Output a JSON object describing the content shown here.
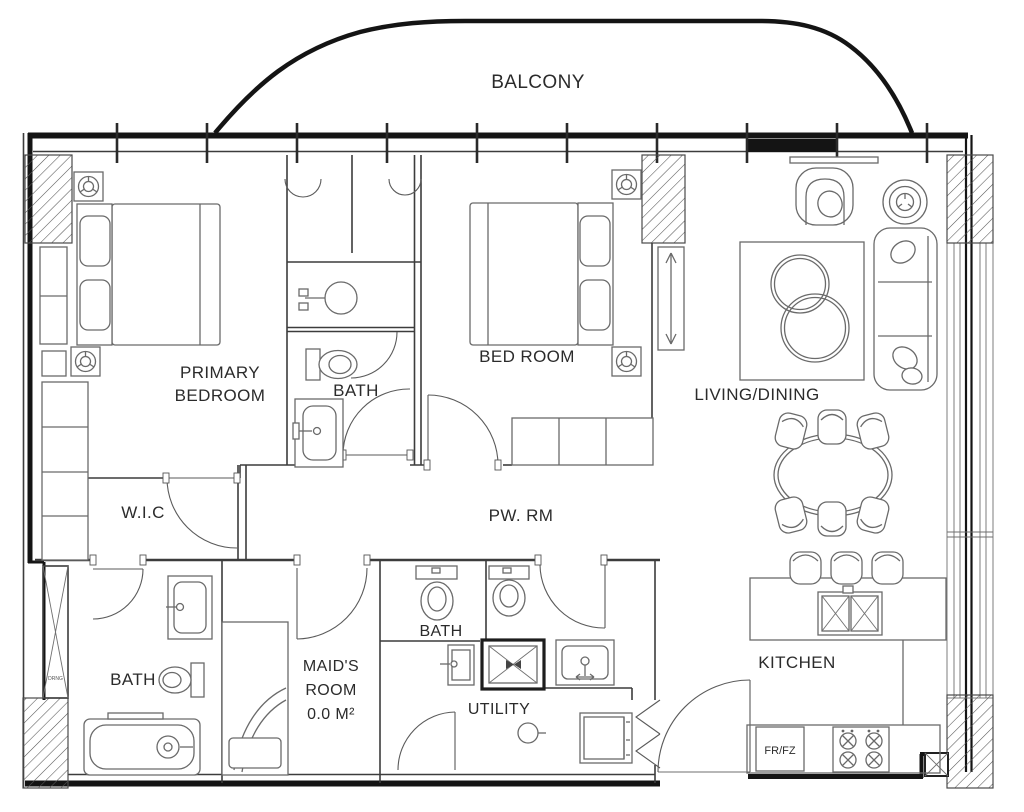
{
  "labels": {
    "balcony": "BALCONY",
    "primary_bedroom": [
      "PRIMARY",
      "BEDROOM"
    ],
    "bath_ensuite": "BATH",
    "bedroom": "BED ROOM",
    "living_dining": "LIVING/DINING",
    "walk_in_closet": "W.I.C",
    "powder_room": "PW. RM",
    "bath_primary": "BATH",
    "maids_room": [
      "MAID'S",
      "ROOM",
      "0.0 M²"
    ],
    "bath_maid": "BATH",
    "utility": "UTILITY",
    "kitchen": "KITCHEN",
    "fridge_freezer": "FR/FZ",
    "drainage": "DRNG"
  },
  "colors": {
    "background": "#ffffff",
    "wall": "#141414",
    "interior_line": "#3c3c3c",
    "furniture_line": "#6a6a6a",
    "label_text": "#2b2b2b"
  }
}
